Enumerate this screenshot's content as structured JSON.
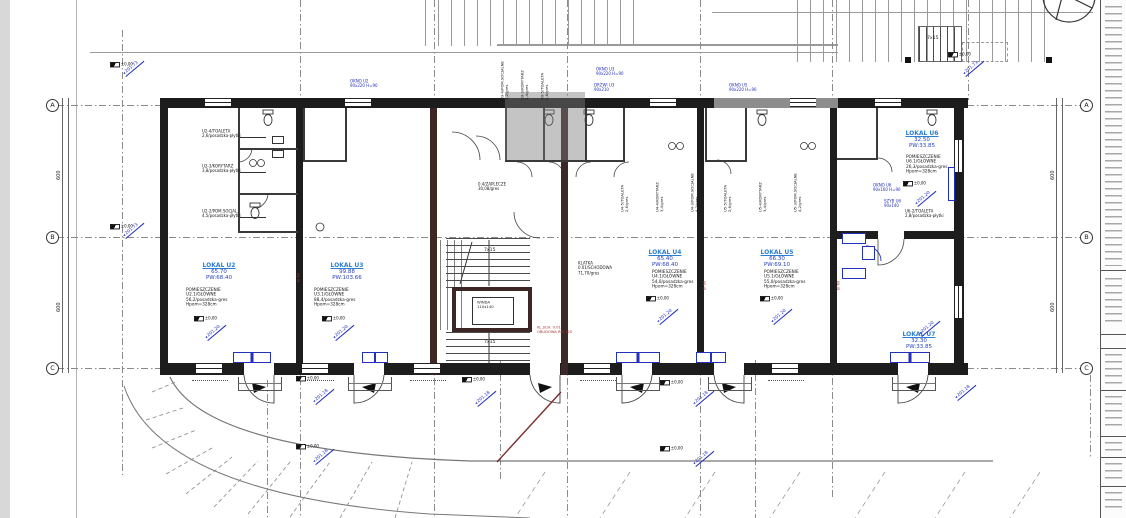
{
  "grid": {
    "rows": [
      {
        "label": "A"
      },
      {
        "label": "B"
      },
      {
        "label": "C"
      }
    ],
    "bay_dim": "600"
  },
  "levels": {
    "zero": "±0,00",
    "e18": "201.18",
    "e20": "201.20",
    "e73": "201.73"
  },
  "units": [
    {
      "name": "LOKAL U2",
      "area": "65.70",
      "pw": "PW:68.40",
      "desc": "POMIESZCZENIE\nU2.1/GŁÓWNE\n56,2/posadzka-gres\nHpom=328cm"
    },
    {
      "name": "LOKAL U3",
      "area": "99.88",
      "pw": "PW:103.66",
      "desc": "POMIESZCZENIE\nU3.1/GŁÓWNE\n88,4/posadzka-gres\nHpom=328cm"
    },
    {
      "name": "LOKAL U4",
      "area": "65.40",
      "pw": "PW:68.40",
      "desc": "POMIESZCZENIE\nU4.1/GŁÓWNE\n54,0/posadzka-gres\nHpom=328cm"
    },
    {
      "name": "LOKAL U5",
      "area": "66.30",
      "pw": "PW:69.10",
      "desc": "POMIESZCZENIE\nU5.1/GŁÓWNE\n55,0/posadzka-gres\nHpom=328cm"
    },
    {
      "name": "LOKAL U6",
      "area": "32.50",
      "pw": "PW:33.85",
      "desc": "POMIESZCZENIE\nU6.1/GŁÓWNE\n26,3/posadzka-gres\nHpom=328cm"
    },
    {
      "name": "LOKAL U7",
      "area": "32.30",
      "pw": "PW:33.85",
      "desc": ""
    }
  ],
  "room_labels": [
    {
      "text": "U2-4/TOALETA\n2,6/posadzka-płytki"
    },
    {
      "text": "U2-3/KORYTARZ\n3,8/posadzka-płytki"
    },
    {
      "text": "U2-2/POM.SOCJAL.\n4,5/posadzka-płytki"
    },
    {
      "text": "U6-2/TOALETA\n2,8/posadzka-płytki"
    }
  ],
  "rotated_labels": [
    {
      "text": "U3-4/POM.SOCJALNE\n4,2/gres"
    },
    {
      "text": "U3-3/KORYTARZ\n3,4/gres"
    },
    {
      "text": "U3-5/TOALETA\n2,6/gres"
    },
    {
      "text": "U4-5/TOALETA\n2,6/gres"
    },
    {
      "text": "U4-4/KORYTARZ\n3,4/gres"
    },
    {
      "text": "U4-3/POM.SOCJALNE\n4,2/gres"
    },
    {
      "text": "U5-5/TOALETA\n2,6/gres"
    },
    {
      "text": "U5-4/KORYTARZ\n3,4/gres"
    },
    {
      "text": "U5-3/POM.SOCJALNE\n4,2/gres"
    }
  ],
  "window_notes": [
    {
      "text": "OKNO U2\n90x220 H=90"
    },
    {
      "text": "OKNO U3\n90x220 H=90"
    },
    {
      "text": "DRZWI U3\n90x210"
    },
    {
      "text": "OKNO U5\n90x220 H=90"
    },
    {
      "text": "OKNO U6\n90x160 H=90"
    },
    {
      "text": "SZYB U6\n90x140"
    }
  ],
  "stair": {
    "flight": "7x15",
    "lift": "WINDA\n110x140",
    "corridor": "0.4/ZAPLECZE\n30,08/gres",
    "klatka": "KLATKA\n0.01/SCHODOWA\n71,70/gres",
    "red_note": "KL.SCH. 0.01\nOBUDOWA REI 120",
    "fire": "EI 60"
  }
}
